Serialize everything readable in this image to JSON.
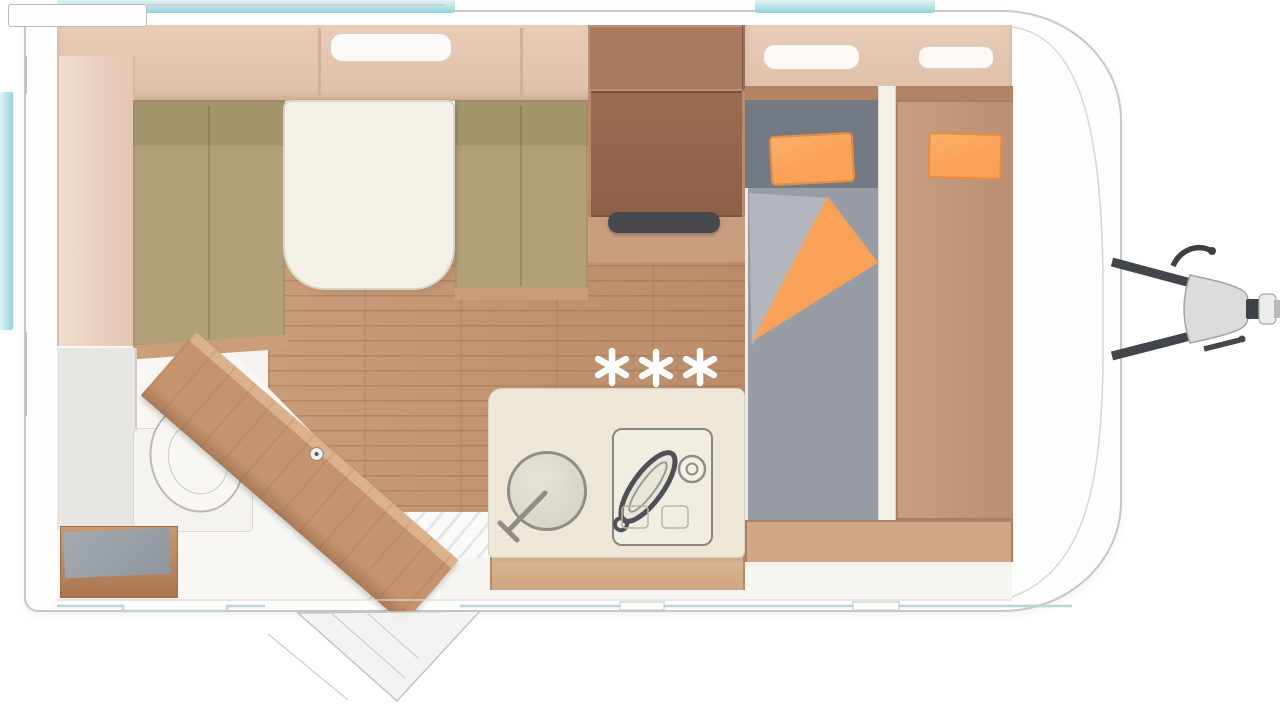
{
  "diagram": {
    "type": "caravan-floorplan-top-view",
    "regions": [
      "dinette-with-table",
      "kitchen-block",
      "bathroom-with-toilet",
      "twin-bed-area",
      "wardrobe",
      "entry-door-open",
      "tow-hitch"
    ]
  },
  "floor_marking": {
    "symbol": "six-spoke-star",
    "count": 3,
    "color": "#ffffff",
    "radius": 16,
    "positions": [
      {
        "x": 612,
        "y": 367
      },
      {
        "x": 656,
        "y": 368
      },
      {
        "x": 700,
        "y": 367
      }
    ]
  },
  "colors": {
    "window_teal_light": "#e0f3f5",
    "window_teal": "#94d3dc",
    "body_outline": "#c7c7c7",
    "body_fill": "#fdfdfd",
    "interior_fill": "#f6f3ef",
    "locker_tan": "#e8ccb7",
    "wood_trim": "#c99e79",
    "wood_dark": "#9b6b51",
    "wood_mid": "#c1916c",
    "cushion_khaki": "#b2a178",
    "table_cream": "#f3f1e7",
    "counter_cream": "#eee7d8",
    "floor_wood": "#c49674",
    "mattress_gray": "#989da5",
    "headboard_gray": "#747a84",
    "sheet_gray": "#b3b7bd",
    "accent_orange": "#f9a156",
    "accent_orange_dark": "#ea8c40",
    "hitch_gray": "#dcdcda",
    "hitch_dark": "#42464a",
    "line_gray": "#bdbdbb",
    "white": "#ffffff"
  }
}
